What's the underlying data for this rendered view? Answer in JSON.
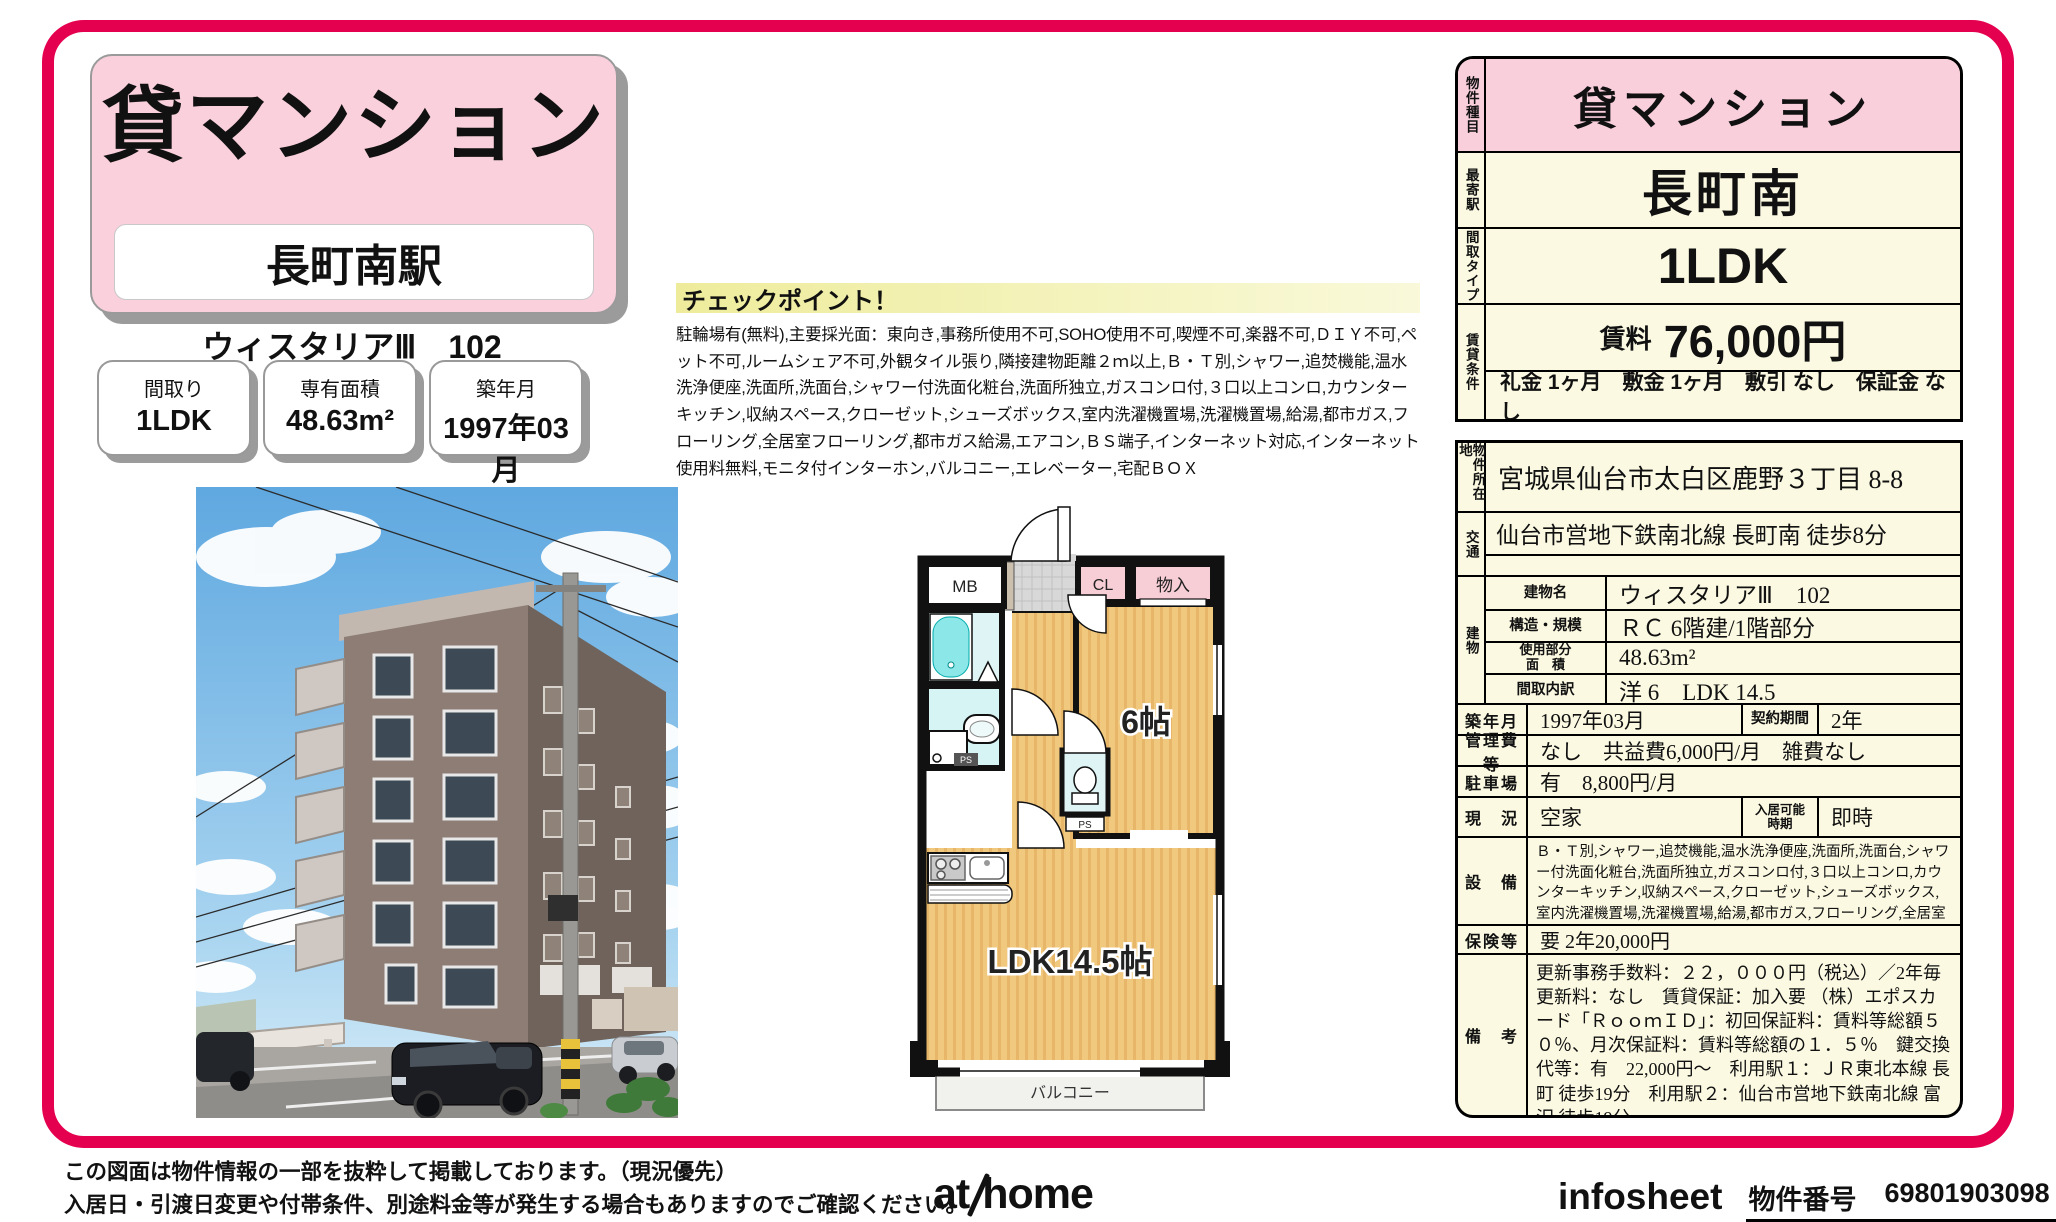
{
  "colors": {
    "accent": "#e5004f",
    "pink": "#f9cfdc",
    "cream": "#fbf9e2",
    "floor_tan": "#f0c87e",
    "bath_cyan": "#dff4f4"
  },
  "header": {
    "category": "貸マンション",
    "station": "長町南駅",
    "property_name": "ウィスタリアⅢ　102"
  },
  "summary_boxes": [
    {
      "label": "間取り",
      "value": "1LDK"
    },
    {
      "label": "専有面積",
      "value": "48.63m²"
    },
    {
      "label": "築年月",
      "value": "1997年03月"
    }
  ],
  "checkpoint": {
    "title": "チェックポイント！",
    "body": "駐輪場有(無料),主要採光面：東向き,事務所使用不可,SOHO使用不可,喫煙不可,楽器不可,ＤＩＹ不可,ペット不可,ルームシェア不可,外観タイル張り,隣接建物距離２ｍ以上,Ｂ・Ｔ別,シャワー,追焚機能,温水洗浄便座,洗面所,洗面台,シャワー付洗面化粧台,洗面所独立,ガスコンロ付,３口以上コンロ,カウンターキッチン,収納スペース,クローゼット,シューズボックス,室内洗濯機置場,洗濯機置場,給湯,都市ガス,フローリング,全居室フローリング,都市ガス給湯,エアコン,ＢＳ端子,インターネット対応,インターネット使用料無料,モニタ付インターホン,バルコニー,エレベーター,宅配ＢＯＸ"
  },
  "floorplan": {
    "mb": "MB",
    "cl": "CL",
    "storage": "物入",
    "room6": "6帖",
    "ldk": "LDK14.5帖",
    "balcony": "バルコニー",
    "ps1": "PS",
    "ps2": "PS"
  },
  "table": {
    "property_type_label": "物件種目",
    "property_type": "貸マンション",
    "station_label": "最寄駅",
    "station": "長町南",
    "layout_label": "間取タイプ",
    "layout": "1LDK",
    "rent_cond_label": "賃貸条件",
    "rent_label": "賃料",
    "rent": "76,000円",
    "terms": "礼金 1ヶ月　敷金 1ヶ月　敷引 なし　保証金 なし",
    "address_label": "物件所在地",
    "address": "宮城県仙台市太白区鹿野３丁目 8-8",
    "access_label": "交通",
    "access": "仙台市営地下鉄南北線 長町南 徒歩8分",
    "building_label": "建物",
    "building_rows": [
      {
        "label": "建物名",
        "value": "ウィスタリアⅢ　102"
      },
      {
        "label": "構造・規模",
        "value": "ＲＣ 6階建/1階部分"
      },
      {
        "label": "使用部分\n面　積",
        "value": "48.63m²"
      },
      {
        "label": "間取内訳",
        "value": "洋 6　LDK 14.5"
      }
    ],
    "built_label": "築年月",
    "built": "1997年03月",
    "contract_label": "契約期間",
    "contract": "2年",
    "mgmt_label": "管理費等",
    "mgmt": "なし　共益費6,000円/月　雑費なし",
    "parking_label": "駐車場",
    "parking": "有　8,800円/月",
    "status_label": "現　況",
    "status": "空家",
    "movein_label": "入居可能\n時期",
    "movein": "即時",
    "equip_label": "設　備",
    "equip": "Ｂ・Ｔ別,シャワー,追焚機能,温水洗浄便座,洗面所,洗面台,シャワー付洗面化粧台,洗面所独立,ガスコンロ付,３口以上コンロ,カウンターキッチン,収納スペース,クローゼット,シューズボックス,室内洗濯機置場,洗濯機置場,給湯,都市ガス,フローリング,全居室フローリング,都市ガス給湯,エア...",
    "insurance_label": "保険等",
    "insurance": "要 2年20,000円",
    "remarks_label": "備　考",
    "remarks": "更新事務手数料：２２，０００円（税込）／2年毎　更新料：なし　賃貸保証：加入要 （株）エポスカード「ＲｏｏｍＩＤ」：初回保証料：賃料等総額５０％、月次保証料：賃料等総額の１．５％　鍵交換代等：有　22,000円～　利用駅１：ＪＲ東北本線 長町 徒歩19分　利用駅２：仙台市営地下鉄南北線 富沢 徒歩19分"
  },
  "footer": {
    "note1": "この図面は物件情報の一部を抜粋して掲載しております。（現況優先）",
    "note2": "入居日・引渡日変更や付帯条件、別途料金等が発生する場合もありますのでご確認ください。",
    "logo_at": "at",
    "logo_home": "home",
    "infosheet": "infosheet",
    "property_no_label": "物件番号",
    "property_no": "69801903098"
  }
}
